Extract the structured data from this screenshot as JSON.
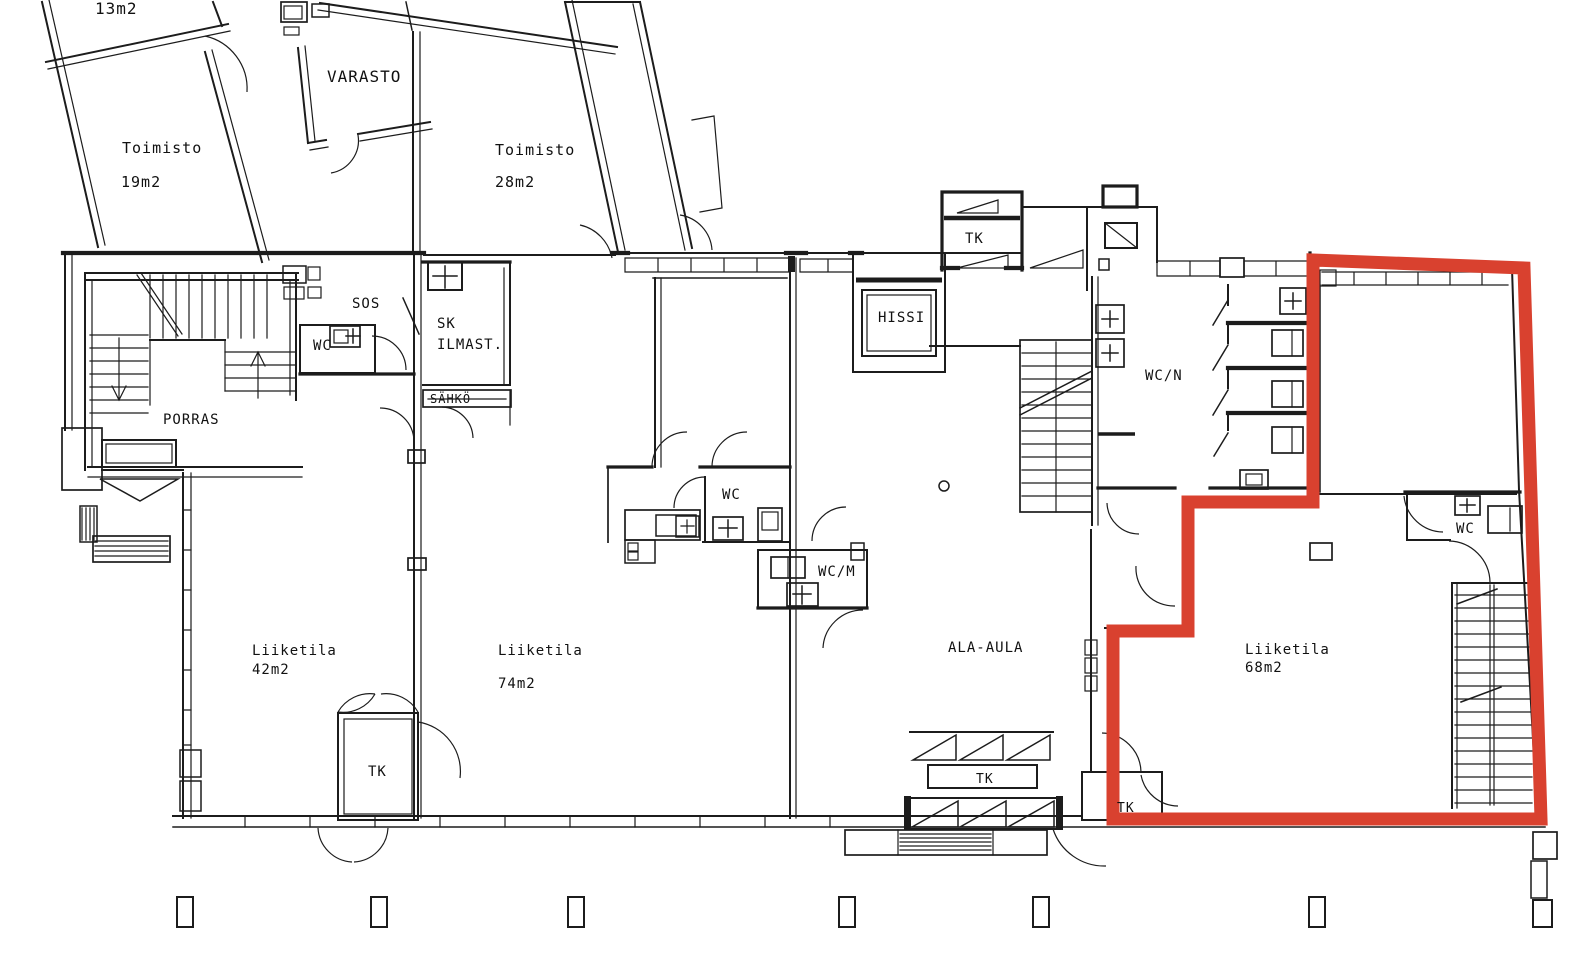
{
  "rooms": {
    "room_13": {
      "area": "13m2"
    },
    "toimisto_19": {
      "name": "Toimisto",
      "area": "19m2"
    },
    "varasto": {
      "name": "VARASTO"
    },
    "toimisto_28": {
      "name": "Toimisto",
      "area": "28m2"
    },
    "sos": {
      "name": "SOS"
    },
    "wc_porras": {
      "name": "WC"
    },
    "sk_ilmast": {
      "name": "SK",
      "name2": "ILMAST."
    },
    "sahko": {
      "name": "SÄHKÖ"
    },
    "porras": {
      "name": "PORRAS"
    },
    "hissi": {
      "name": "HISSI"
    },
    "tk_top": {
      "name": "TK"
    },
    "wc_n": {
      "name": "WC/N"
    },
    "wc_mid": {
      "name": "WC"
    },
    "wc_m": {
      "name": "WC/M"
    },
    "ala_aula": {
      "name": "ALA-AULA"
    },
    "liiketila_42": {
      "name": "Liiketila",
      "area": "42m2"
    },
    "tk_left": {
      "name": "TK"
    },
    "liiketila_74": {
      "name": "Liiketila",
      "area": "74m2"
    },
    "liiketila_68": {
      "name": "Liiketila",
      "area": "68m2"
    },
    "wc_right": {
      "name": "WC"
    },
    "tk_mid": {
      "name": "TK"
    },
    "tk_red": {
      "name": "TK"
    }
  },
  "highlight": {
    "outline_color": "#d9412f"
  },
  "line_color": "#1c1c1c"
}
